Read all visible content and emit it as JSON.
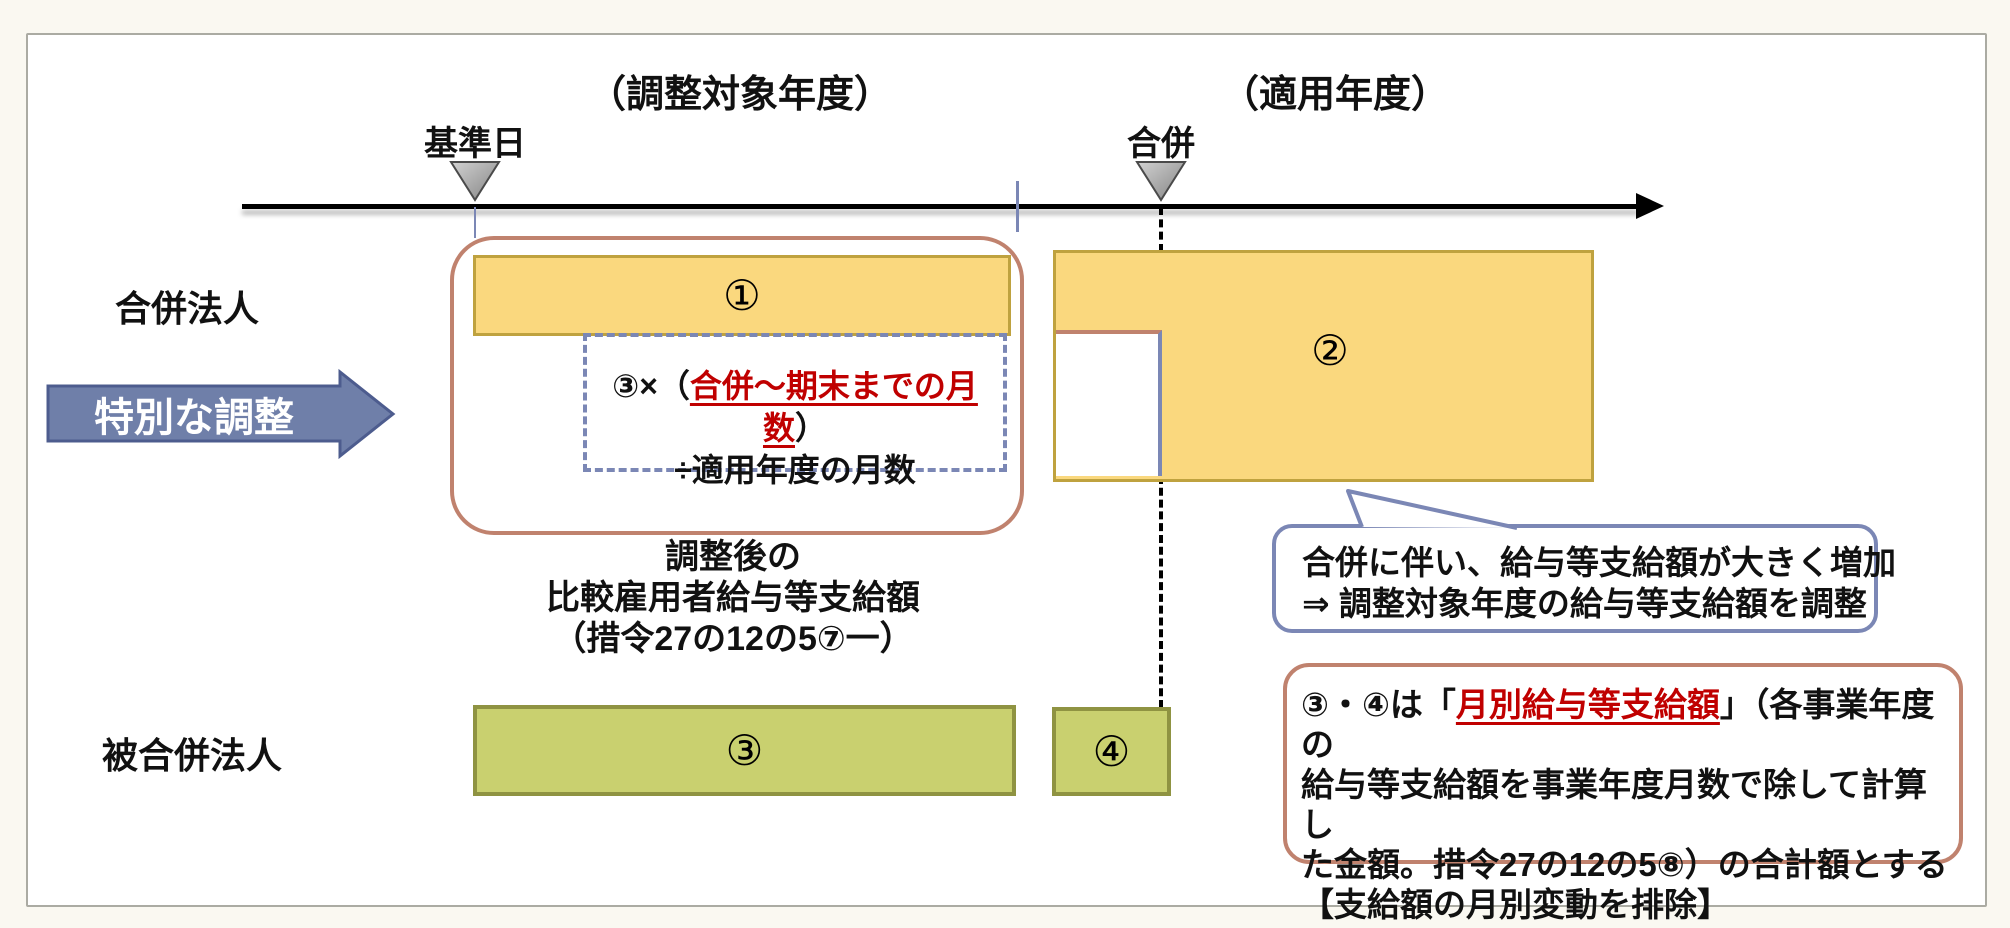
{
  "headers": {
    "left": "（調整対象年度）",
    "right": "（適用年度）"
  },
  "timeline": {
    "marker_left": "基準日",
    "marker_right": "合併"
  },
  "rows": {
    "merging_corp": "合併法人",
    "merged_corp": "被合併法人"
  },
  "process_arrow": {
    "label": "特別な調整"
  },
  "bars": {
    "bar1": "①",
    "bar2": "②",
    "bar3": "③",
    "bar4": "④"
  },
  "formula": {
    "prefix": "③×（",
    "highlight": "合併～期末までの月数",
    "suffix": "）",
    "line2": "÷適用年度の月数"
  },
  "caption": {
    "line1": "調整後の",
    "line2": "比較雇用者給与等支給額",
    "line3": "（措令27の12の5⑦一）"
  },
  "bubble": {
    "line1": "合併に伴い、給与等支給額が大きく増加",
    "line2": "⇒ 調整対象年度の給与等支給額を調整"
  },
  "note": {
    "l1_pre": "③・④は「",
    "l1_red": "月別給与等支給額",
    "l1_post": "」（各事業年度の",
    "l2": "給与等支給額を事業年度月数で除して計算し",
    "l3": "た金額。措令27の12の5⑧）の合計額とする",
    "l4": "【支給額の月別変動を排除】"
  },
  "colors": {
    "yellow_fill": "#FAD87E",
    "yellow_border": "#BFA23F",
    "green_fill": "#C9D06F",
    "green_border": "#8F9342",
    "salmon_border": "#C0826E",
    "slate_blue": "#7B87B5",
    "arrow_fill": "#6F7FA9",
    "arrow_border": "#4D5C8E",
    "highlight_red": "#C00000",
    "marker_gray": "#A6A6A6"
  }
}
